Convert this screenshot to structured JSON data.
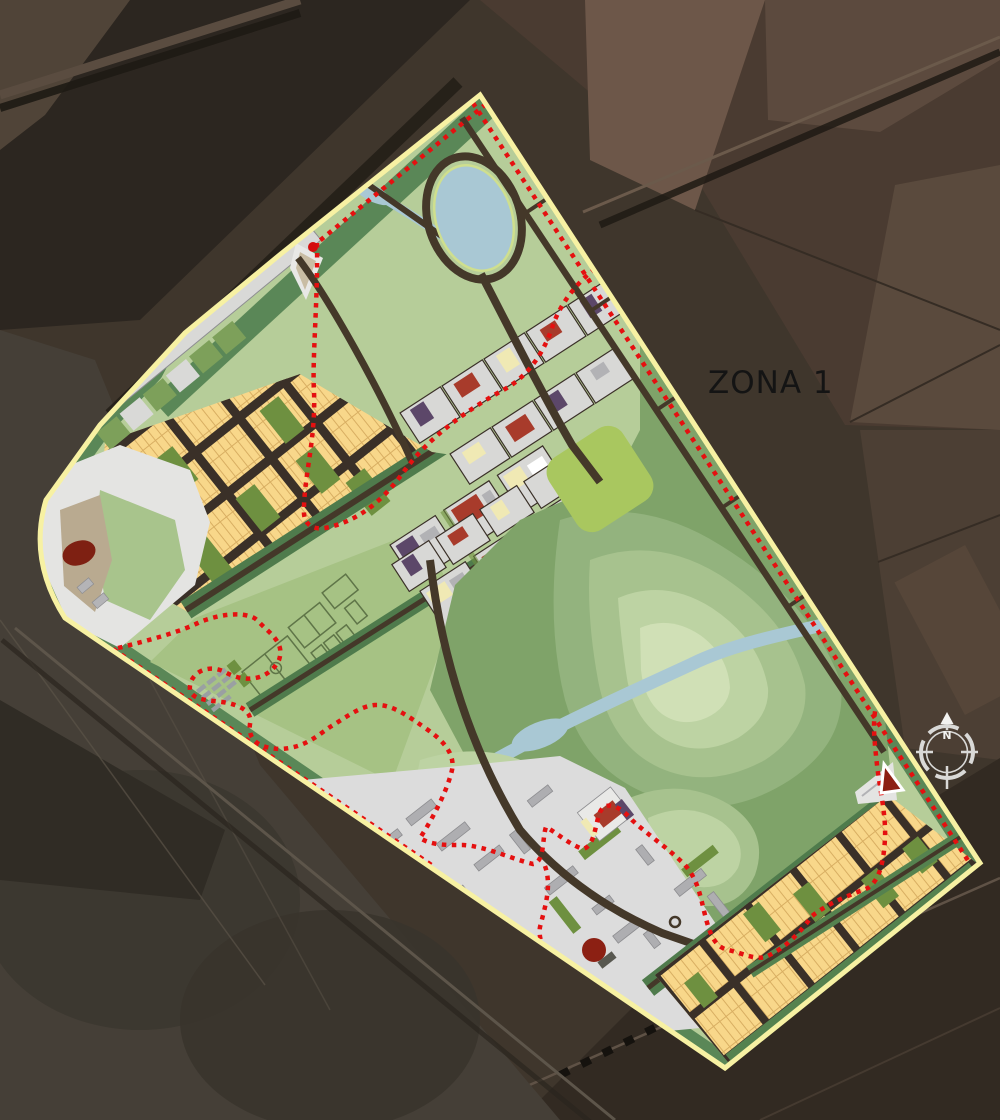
{
  "map": {
    "zone_label": "ZONA 1",
    "compass": {
      "north_label": "N"
    },
    "colors": {
      "satellite_base": "#3f362c",
      "satellite_dark": "#2c2620",
      "satellite_field_pink": "#6d5749",
      "satellite_field_light": "#5c4a3e",
      "plan_park_light": "#b6cd99",
      "plan_edge_band_green": "#5a8757",
      "park_contour_1": "#7fa369",
      "park_contour_2": "#93b37e",
      "park_contour_3": "#a7c28e",
      "park_contour_4": "#bdd3a3",
      "park_contour_5": "#d0e0b6",
      "bright_meadow": "#a9c75f",
      "water_blue": "#a9c8d4",
      "lake_shore_line": "#cfdf8e",
      "road_dark_brown": "#443829",
      "residential_lot_yellow": "#f8d78a",
      "residential_lot_line": "#d8ae62",
      "street_dark": "#3a3028",
      "olive_green_block": "#6e9040",
      "civic_white": "#e4e4e2",
      "mixed_block_gray": "#d8d8d6",
      "building_red": "#a83b2b",
      "building_purple": "#5c4769",
      "building_pale_yellow": "#f0e9b4",
      "building_gray": "#aeaeb1",
      "industrial_ground": "#dcdcdc",
      "landmark_dark_red": "#8c2013",
      "boundary_yellow": "#f7f1a3",
      "boundary_red_dotted": "#e51010",
      "compass_ring": "#d9d9d7"
    },
    "regions": [
      "satellite-farmland",
      "north-park-with-lake",
      "west-residential-lots",
      "northwest-industrial-strip",
      "west-civic-corner",
      "sports-fields",
      "town-center-blocks",
      "mixed-use-boulevard-strips",
      "east-landscape-park",
      "south-industrial-zone",
      "southeast-residential-lots"
    ]
  }
}
